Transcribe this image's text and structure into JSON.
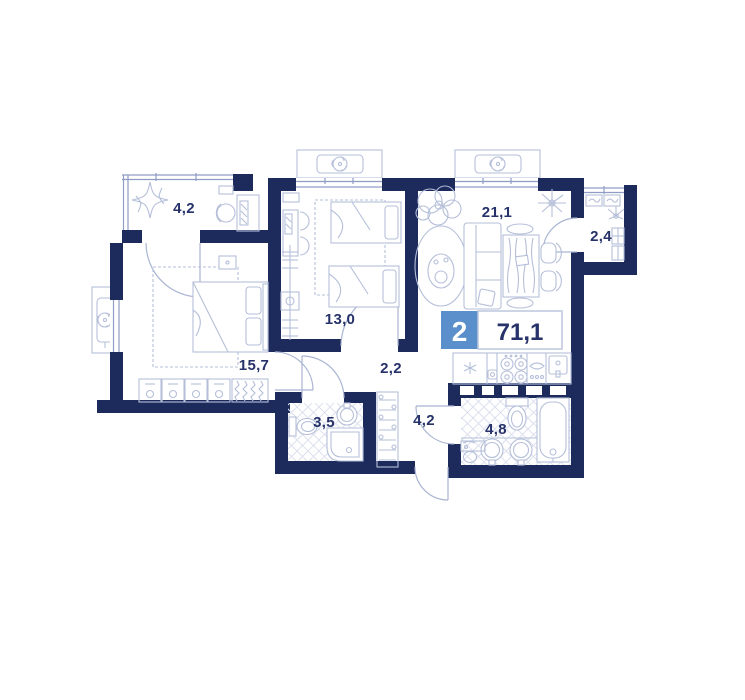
{
  "plan": {
    "badge": {
      "rooms_count": "2",
      "total_area": "71,1"
    },
    "rooms": {
      "balcony_top_left": "4,2",
      "bedroom_second": "13,0",
      "living_kitchen": "21,1",
      "balcony_right": "2,4",
      "bedroom_master": "15,7",
      "hall": "2,2",
      "bathroom_shower": "3,5",
      "corridor": "4,2",
      "bathroom_main": "4,8"
    },
    "colors": {
      "wall": "#1d2a5c",
      "furniture_line": "#b5bfd9",
      "accent_blue": "#5b8fcb",
      "label_text": "#263269",
      "background": "#ffffff"
    },
    "icons": [
      "ac-unit-icon",
      "fan-icon",
      "bed-icon",
      "double-bed-icon",
      "wardrobe-icon",
      "hanger-rail-icon",
      "desk-icon",
      "chair-icon",
      "plant-icon",
      "sparkle-plant-icon",
      "sofa-icon",
      "dining-table-icon",
      "rug-icon",
      "fridge-snowflake-icon",
      "cooktop-icon",
      "kitchen-sink-icon",
      "toilet-icon",
      "bathtub-icon",
      "washbasin-icon",
      "shower-icon",
      "shelf-rack-icon",
      "door-arc-icon",
      "window-icon"
    ]
  }
}
